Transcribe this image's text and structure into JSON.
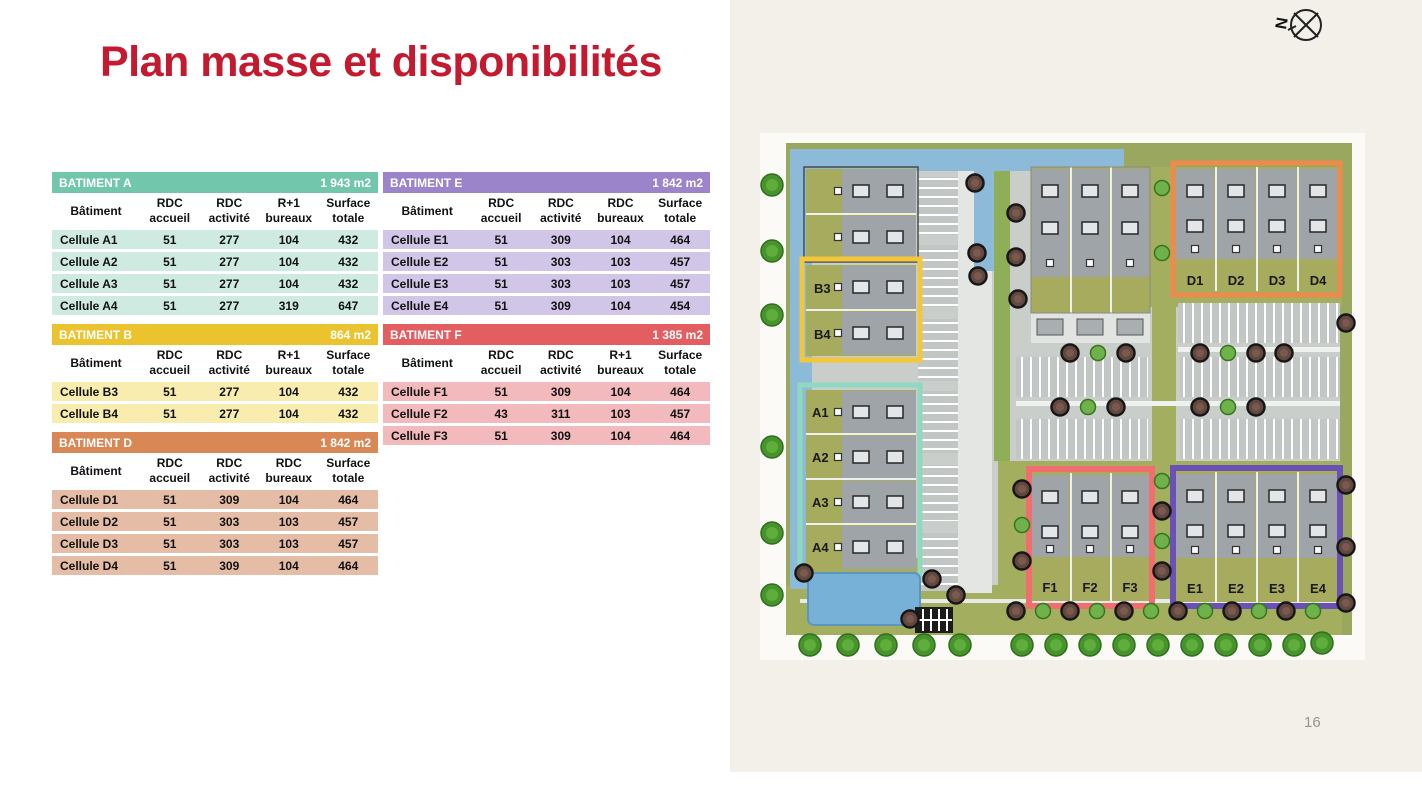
{
  "slide": {
    "title": "Plan masse et disponibilités",
    "page_number": "16"
  },
  "compass": {
    "label": "N"
  },
  "map": {
    "units": {
      "a": [
        "A1",
        "A2",
        "A3",
        "A4"
      ],
      "b": [
        "B3",
        "B4"
      ],
      "d": [
        "D1",
        "D2",
        "D3",
        "D4"
      ],
      "e": [
        "E1",
        "E2",
        "E3",
        "E4"
      ],
      "f": [
        "F1",
        "F2",
        "F3"
      ]
    },
    "outline_colors": {
      "a": "#8fd9c0",
      "b": "#f3c73a",
      "d": "#ef8a4e",
      "e": "#6b50b5",
      "f": "#f26d6f"
    },
    "water_color": "#8cbad8"
  },
  "tables": [
    {
      "id": "A",
      "title": "BATIMENT A",
      "area": "1 943 m2",
      "header_color": "#72c6ac",
      "row_color": "#cfebe1",
      "columns": [
        {
          "l1": "Bâtiment",
          "l2": ""
        },
        {
          "l1": "RDC",
          "l2": "accueil"
        },
        {
          "l1": "RDC",
          "l2": "activité"
        },
        {
          "l1": "R+1",
          "l2": "bureaux"
        },
        {
          "l1": "Surface",
          "l2": "totale"
        }
      ],
      "rows": [
        [
          "Cellule A1",
          "51",
          "277",
          "104",
          "432"
        ],
        [
          "Cellule A2",
          "51",
          "277",
          "104",
          "432"
        ],
        [
          "Cellule A3",
          "51",
          "277",
          "104",
          "432"
        ],
        [
          "Cellule A4",
          "51",
          "277",
          "319",
          "647"
        ]
      ]
    },
    {
      "id": "B",
      "title": "BATIMENT B",
      "area": "864 m2",
      "header_color": "#eac32f",
      "row_color": "#f8ecae",
      "columns": [
        {
          "l1": "Bâtiment",
          "l2": ""
        },
        {
          "l1": "RDC",
          "l2": "accueil"
        },
        {
          "l1": "RDC",
          "l2": "activité"
        },
        {
          "l1": "R+1",
          "l2": "bureaux"
        },
        {
          "l1": "Surface",
          "l2": "totale"
        }
      ],
      "rows": [
        [
          "Cellule B3",
          "51",
          "277",
          "104",
          "432"
        ],
        [
          "Cellule B4",
          "51",
          "277",
          "104",
          "432"
        ]
      ]
    },
    {
      "id": "D",
      "title": "BATIMENT D",
      "area": "1 842 m2",
      "header_color": "#d98755",
      "row_color": "#e5bda6",
      "columns": [
        {
          "l1": "Bâtiment",
          "l2": ""
        },
        {
          "l1": "RDC",
          "l2": "accueil"
        },
        {
          "l1": "RDC",
          "l2": "activité"
        },
        {
          "l1": "RDC",
          "l2": "bureaux"
        },
        {
          "l1": "Surface",
          "l2": "totale"
        }
      ],
      "rows": [
        [
          "Cellule D1",
          "51",
          "309",
          "104",
          "464"
        ],
        [
          "Cellule D2",
          "51",
          "303",
          "103",
          "457"
        ],
        [
          "Cellule D3",
          "51",
          "303",
          "103",
          "457"
        ],
        [
          "Cellule D4",
          "51",
          "309",
          "104",
          "464"
        ]
      ]
    },
    {
      "id": "E",
      "title": "BATIMENT E",
      "area": "1 842 m2",
      "header_color": "#9c84ca",
      "row_color": "#d2c6e8",
      "columns": [
        {
          "l1": "Bâtiment",
          "l2": ""
        },
        {
          "l1": "RDC",
          "l2": "accueil"
        },
        {
          "l1": "RDC",
          "l2": "activité"
        },
        {
          "l1": "RDC",
          "l2": "bureaux"
        },
        {
          "l1": "Surface",
          "l2": "totale"
        }
      ],
      "rows": [
        [
          "Cellule E1",
          "51",
          "309",
          "104",
          "464"
        ],
        [
          "Cellule E2",
          "51",
          "303",
          "103",
          "457"
        ],
        [
          "Cellule E3",
          "51",
          "303",
          "103",
          "457"
        ],
        [
          "Cellule E4",
          "51",
          "309",
          "104",
          "454"
        ]
      ]
    },
    {
      "id": "F",
      "title": "BATIMENT F",
      "area": "1 385 m2",
      "header_color": "#e45d60",
      "row_color": "#f3babd",
      "columns": [
        {
          "l1": "Bâtiment",
          "l2": ""
        },
        {
          "l1": "RDC",
          "l2": "accueil"
        },
        {
          "l1": "RDC",
          "l2": "activité"
        },
        {
          "l1": "R+1",
          "l2": "bureaux"
        },
        {
          "l1": "Surface",
          "l2": "totale"
        }
      ],
      "rows": [
        [
          "Cellule F1",
          "51",
          "309",
          "104",
          "464"
        ],
        [
          "Cellule F2",
          "43",
          "311",
          "103",
          "457"
        ],
        [
          "Cellule F3",
          "51",
          "309",
          "104",
          "464"
        ]
      ]
    }
  ]
}
